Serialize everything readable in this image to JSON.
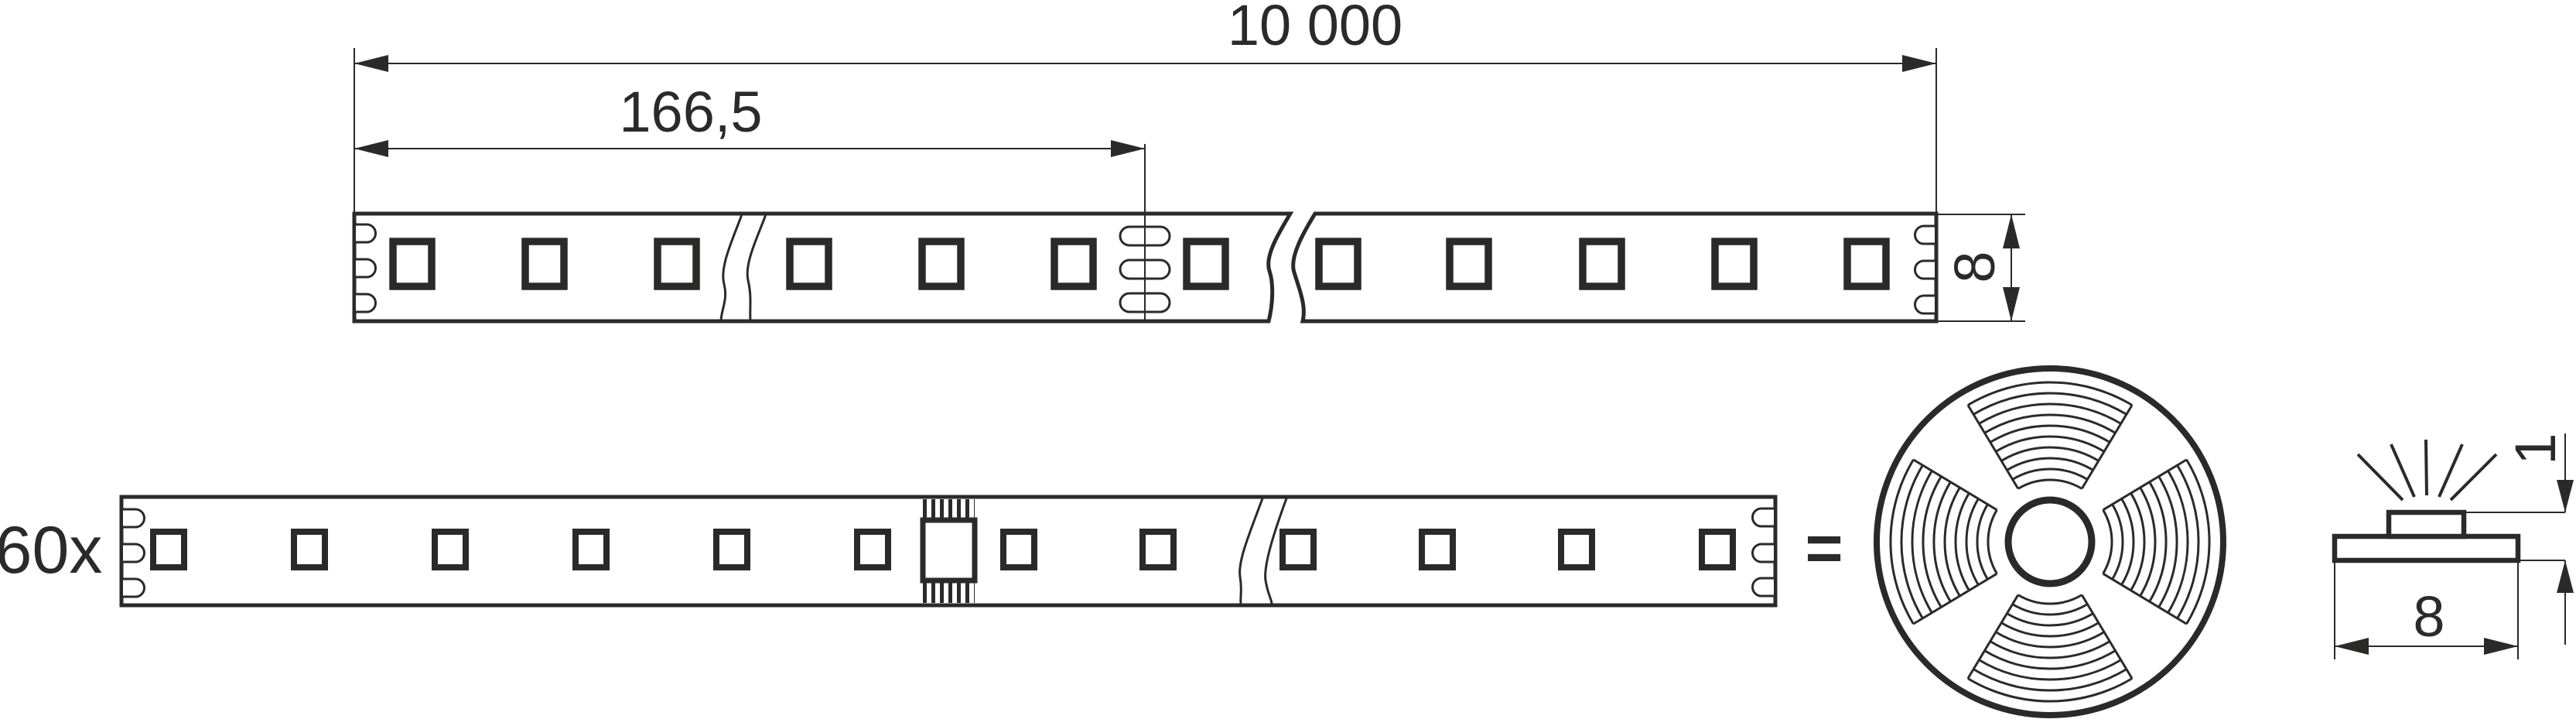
{
  "drawing": {
    "kind": "LED strip dimensional technical drawing",
    "colors": {
      "ink": "#2b2a29",
      "background": "#ffffff"
    }
  },
  "top_view": {
    "total_length_label": "10 000",
    "segment_length_label": "166,5",
    "strip_width_label": "8"
  },
  "bottom_view": {
    "quantity_label": "60x",
    "equals_label": "="
  },
  "cross_section": {
    "height_label": "1",
    "width_label": "8"
  }
}
